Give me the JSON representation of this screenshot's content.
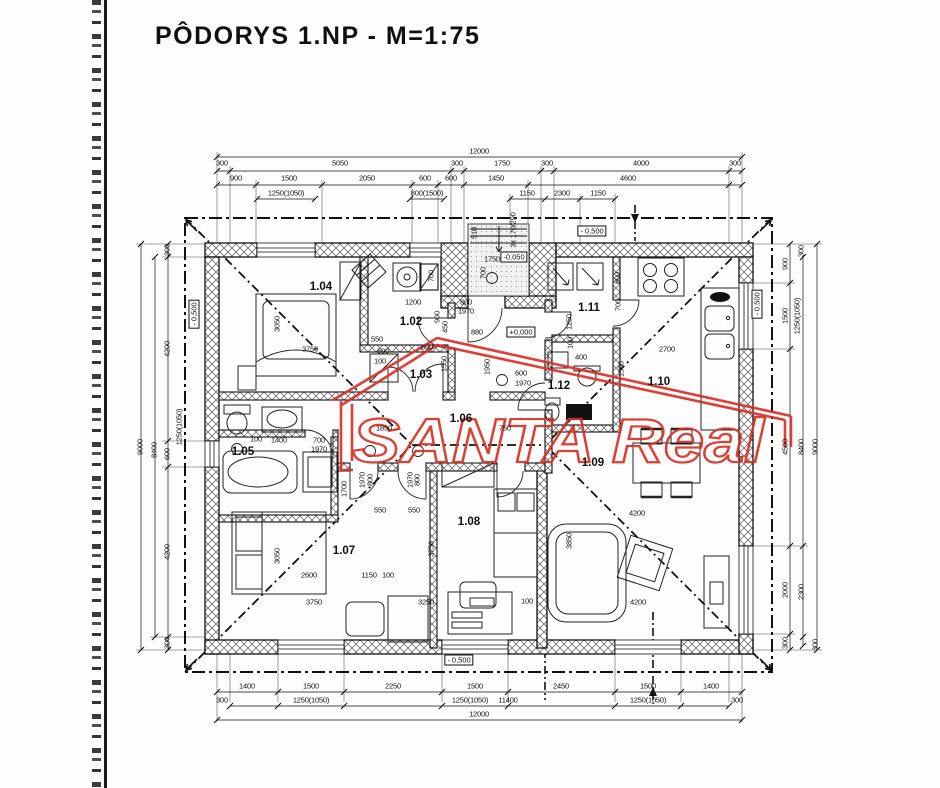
{
  "page": {
    "title": "PÔDORYS 1.NP - M=1:75"
  },
  "watermark": {
    "text": "SANTA Real",
    "color": "#d93025"
  },
  "colors": {
    "ink": "#141414",
    "hatch": "#555",
    "watermark_red": "#d93025"
  },
  "room_labels": [
    {
      "t": "1.02",
      "x": 411,
      "y": 322
    },
    {
      "t": "1.03",
      "x": 421,
      "y": 375
    },
    {
      "t": "1.04",
      "x": 321,
      "y": 287
    },
    {
      "t": "1.05",
      "x": 243,
      "y": 452
    },
    {
      "t": "1.06",
      "x": 461,
      "y": 419
    },
    {
      "t": "1.07",
      "x": 344,
      "y": 551
    },
    {
      "t": "1.08",
      "x": 469,
      "y": 522
    },
    {
      "t": "1.09",
      "x": 593,
      "y": 463
    },
    {
      "t": "1.10",
      "x": 659,
      "y": 382
    },
    {
      "t": "1.11",
      "x": 589,
      "y": 308
    },
    {
      "t": "1.12",
      "x": 559,
      "y": 386
    }
  ],
  "level_markers": [
    {
      "t": "- 0,500",
      "x": 592,
      "y": 231,
      "r": 0
    },
    {
      "t": "-0,050",
      "x": 514,
      "y": 257,
      "r": 0
    },
    {
      "t": "+0,000",
      "x": 521,
      "y": 332,
      "r": 0
    },
    {
      "t": "- 0,500",
      "x": 459,
      "y": 660,
      "r": 0
    },
    {
      "t": "- 0,500",
      "x": 757,
      "y": 304,
      "r": -90
    },
    {
      "t": "- 0,500",
      "x": 194,
      "y": 314,
      "r": -90
    }
  ],
  "dimension_labels": [
    {
      "t": "12000",
      "x": 479,
      "y": 151
    },
    {
      "t": "300",
      "x": 222,
      "y": 163
    },
    {
      "t": "5050",
      "x": 340,
      "y": 163
    },
    {
      "t": "300",
      "x": 457,
      "y": 163
    },
    {
      "t": "1750",
      "x": 502,
      "y": 163
    },
    {
      "t": "300",
      "x": 547,
      "y": 163
    },
    {
      "t": "4000",
      "x": 641,
      "y": 163
    },
    {
      "t": "300",
      "x": 735,
      "y": 163
    },
    {
      "t": "900",
      "x": 236,
      "y": 178
    },
    {
      "t": "1500",
      "x": 289,
      "y": 178
    },
    {
      "t": "2050",
      "x": 367,
      "y": 178
    },
    {
      "t": "600",
      "x": 425,
      "y": 178
    },
    {
      "t": "600",
      "x": 451,
      "y": 178
    },
    {
      "t": "1450",
      "x": 496,
      "y": 178
    },
    {
      "t": "4600",
      "x": 628,
      "y": 178
    },
    {
      "t": "1250(1050)",
      "x": 286,
      "y": 193
    },
    {
      "t": "800(1500)",
      "x": 427,
      "y": 193
    },
    {
      "t": "1150",
      "x": 527,
      "y": 193
    },
    {
      "t": "2300",
      "x": 562,
      "y": 193
    },
    {
      "t": "1150",
      "x": 598,
      "y": 193
    },
    {
      "t": "1400",
      "x": 247,
      "y": 686
    },
    {
      "t": "1500",
      "x": 311,
      "y": 686
    },
    {
      "t": "2250",
      "x": 393,
      "y": 686
    },
    {
      "t": "1500",
      "x": 475,
      "y": 686
    },
    {
      "t": "2450",
      "x": 561,
      "y": 686
    },
    {
      "t": "1500",
      "x": 648,
      "y": 686
    },
    {
      "t": "1400",
      "x": 711,
      "y": 686
    },
    {
      "t": "300",
      "x": 222,
      "y": 700
    },
    {
      "t": "1250(1050)",
      "x": 311,
      "y": 700
    },
    {
      "t": "1250(1050)",
      "x": 470,
      "y": 700
    },
    {
      "t": "11400",
      "x": 508,
      "y": 700
    },
    {
      "t": "1250(1050)",
      "x": 648,
      "y": 700
    },
    {
      "t": "300",
      "x": 737,
      "y": 700
    },
    {
      "t": "12000",
      "x": 479,
      "y": 714
    },
    {
      "t": "9000",
      "x": 140,
      "y": 447,
      "r": -90
    },
    {
      "t": "8400",
      "x": 154,
      "y": 450,
      "r": -90
    },
    {
      "t": "300",
      "x": 167,
      "y": 250,
      "r": -90
    },
    {
      "t": "4200",
      "x": 167,
      "y": 349,
      "r": -90
    },
    {
      "t": "600",
      "x": 167,
      "y": 454,
      "r": -90
    },
    {
      "t": "4200",
      "x": 167,
      "y": 552,
      "r": -90
    },
    {
      "t": "300",
      "x": 167,
      "y": 643,
      "r": -90
    },
    {
      "t": "1250(1050)",
      "x": 179,
      "y": 427,
      "r": -90
    },
    {
      "t": "900",
      "x": 785,
      "y": 264,
      "r": -90
    },
    {
      "t": "1500",
      "x": 785,
      "y": 316,
      "r": -90
    },
    {
      "t": "4500",
      "x": 785,
      "y": 447,
      "r": -90
    },
    {
      "t": "2000",
      "x": 785,
      "y": 590,
      "r": -90
    },
    {
      "t": "300",
      "x": 785,
      "y": 643,
      "r": -90
    },
    {
      "t": "1250(1050)",
      "x": 797,
      "y": 316,
      "r": -90
    },
    {
      "t": "8400",
      "x": 801,
      "y": 447,
      "r": -90
    },
    {
      "t": "2300",
      "x": 801,
      "y": 592,
      "r": -90
    },
    {
      "t": "300",
      "x": 801,
      "y": 251,
      "r": -90
    },
    {
      "t": "9000",
      "x": 815,
      "y": 447,
      "r": -90
    },
    {
      "t": "300",
      "x": 815,
      "y": 645,
      "r": -90
    }
  ],
  "annotations": [
    {
      "t": "3x 170/290",
      "x": 513,
      "y": 230,
      "r": -90
    },
    {
      "t": "510",
      "x": 474,
      "y": 233,
      "r": -90
    },
    {
      "t": "1750",
      "x": 492,
      "y": 259
    },
    {
      "t": "700",
      "x": 483,
      "y": 273,
      "r": -90
    },
    {
      "t": "1200",
      "x": 413,
      "y": 302
    },
    {
      "t": "700",
      "x": 431,
      "y": 276,
      "r": -90
    },
    {
      "t": "900",
      "x": 437,
      "y": 317,
      "r": -90
    },
    {
      "t": "800",
      "x": 466,
      "y": 302
    },
    {
      "t": "1970",
      "x": 466,
      "y": 311
    },
    {
      "t": "880",
      "x": 477,
      "y": 332
    },
    {
      "t": "450",
      "x": 445,
      "y": 327,
      "r": -90
    },
    {
      "t": "3050",
      "x": 277,
      "y": 324,
      "r": -90
    },
    {
      "t": "3750",
      "x": 310,
      "y": 349
    },
    {
      "t": "550",
      "x": 377,
      "y": 339
    },
    {
      "t": "600",
      "x": 383,
      "y": 351
    },
    {
      "t": "100",
      "x": 380,
      "y": 361
    },
    {
      "t": "800",
      "x": 427,
      "y": 347
    },
    {
      "t": "1550",
      "x": 444,
      "y": 364,
      "r": -90
    },
    {
      "t": "1950",
      "x": 487,
      "y": 367,
      "r": -90
    },
    {
      "t": "600",
      "x": 521,
      "y": 373
    },
    {
      "t": "1970",
      "x": 523,
      "y": 383
    },
    {
      "t": "1250",
      "x": 569,
      "y": 322,
      "r": -90
    },
    {
      "t": "100",
      "x": 570,
      "y": 343,
      "r": -90
    },
    {
      "t": "400",
      "x": 581,
      "y": 357
    },
    {
      "t": "600",
      "x": 617,
      "y": 278,
      "r": -90
    },
    {
      "t": "700",
      "x": 618,
      "y": 305,
      "r": -90
    },
    {
      "t": "2700",
      "x": 667,
      "y": 349
    },
    {
      "t": "1550",
      "x": 621,
      "y": 369,
      "r": -90
    },
    {
      "t": "1850",
      "x": 384,
      "y": 428
    },
    {
      "t": "750",
      "x": 505,
      "y": 428
    },
    {
      "t": "100",
      "x": 256,
      "y": 439
    },
    {
      "t": "1400",
      "x": 279,
      "y": 440
    },
    {
      "t": "700",
      "x": 319,
      "y": 440
    },
    {
      "t": "1970",
      "x": 319,
      "y": 449
    },
    {
      "t": "1700",
      "x": 344,
      "y": 489,
      "r": -90
    },
    {
      "t": "1970",
      "x": 362,
      "y": 480,
      "r": -90
    },
    {
      "t": "800",
      "x": 370,
      "y": 480,
      "r": -90
    },
    {
      "t": "1970",
      "x": 410,
      "y": 480,
      "r": -90
    },
    {
      "t": "800",
      "x": 417,
      "y": 480,
      "r": -90
    },
    {
      "t": "550",
      "x": 380,
      "y": 510
    },
    {
      "t": "550",
      "x": 414,
      "y": 510
    },
    {
      "t": "3050",
      "x": 277,
      "y": 556,
      "r": -90
    },
    {
      "t": "2600",
      "x": 309,
      "y": 575
    },
    {
      "t": "3750",
      "x": 314,
      "y": 602
    },
    {
      "t": "1150",
      "x": 369,
      "y": 575
    },
    {
      "t": "100",
      "x": 388,
      "y": 575
    },
    {
      "t": "3750",
      "x": 431,
      "y": 549,
      "r": -90
    },
    {
      "t": "3250",
      "x": 426,
      "y": 602
    },
    {
      "t": "100",
      "x": 527,
      "y": 601
    },
    {
      "t": "3850",
      "x": 569,
      "y": 541,
      "r": -90
    },
    {
      "t": "4200",
      "x": 637,
      "y": 513
    },
    {
      "t": "4200",
      "x": 638,
      "y": 602
    }
  ]
}
